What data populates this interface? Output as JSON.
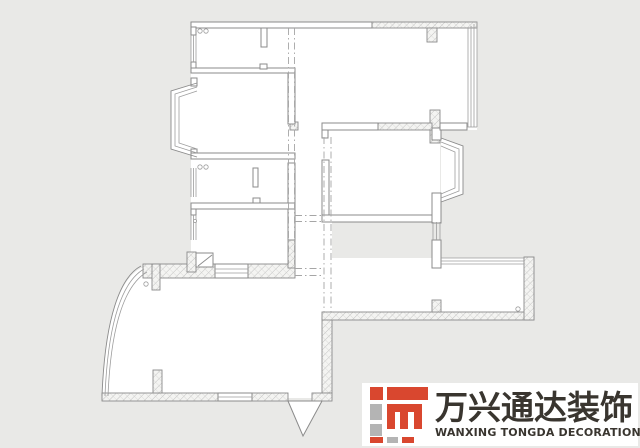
{
  "colors": {
    "bg": "#e9e9e7",
    "paper": "#ffffff",
    "line": "#8b8b8b",
    "line-light": "#9d9d9d",
    "dash": "#a6a6a6",
    "logo-red": "#d9472f",
    "logo-gray": "#b4b4b4",
    "logo-text": "#39352f"
  },
  "floor_plan": {
    "type": "residential-apartment-floor-plan",
    "text_labels": [],
    "elements": [
      "outer-walls",
      "interior-walls",
      "hatched-masonry-walls",
      "triple-line-windows",
      "bay-window-left",
      "bay-window-right",
      "curved-balcony-window",
      "entry-door-wedge",
      "beam-dash-dot-lines",
      "door-hinge-circles",
      "structural-columns"
    ]
  },
  "logo": {
    "cn": "万兴通达装饰",
    "en": "WANXING TONGDA DECORATION",
    "mark": "red-gray-block-monogram"
  }
}
